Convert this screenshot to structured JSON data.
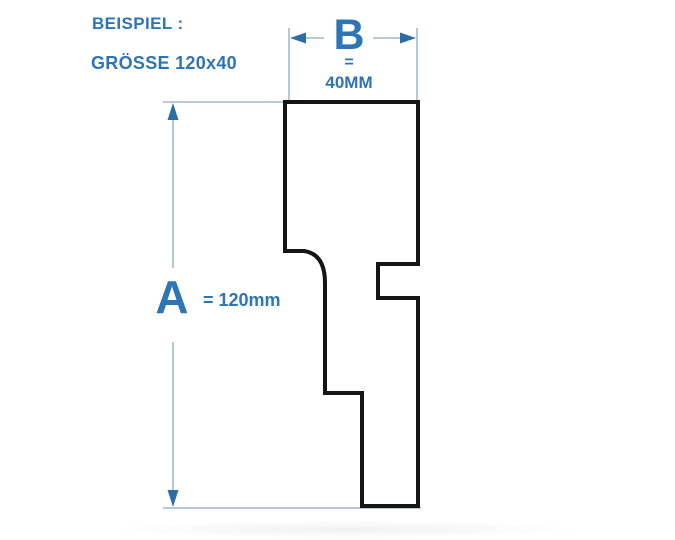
{
  "header": {
    "example_label": "BEISPIEL :",
    "size_label": "GRÖSSE 120x40"
  },
  "dimension_b": {
    "letter": "B",
    "equals": "=",
    "value": "40MM"
  },
  "dimension_a": {
    "letter": "A",
    "value": "= 120mm"
  },
  "profile": {
    "description": "skirting-board cross-section outline",
    "path": "M 285 102 H 418 V 264 H 378 V 298 H 418 V 506 H 362 V 393 H 325 V 283 Q 325 254 304 251 H 285 Z"
  },
  "colors": {
    "label_blue": "#2E75B6",
    "dimension_line": "#8FA9C6",
    "arrowhead": "#2E6DA4",
    "profile_outline": "#151515",
    "background": "#FFFFFF"
  }
}
